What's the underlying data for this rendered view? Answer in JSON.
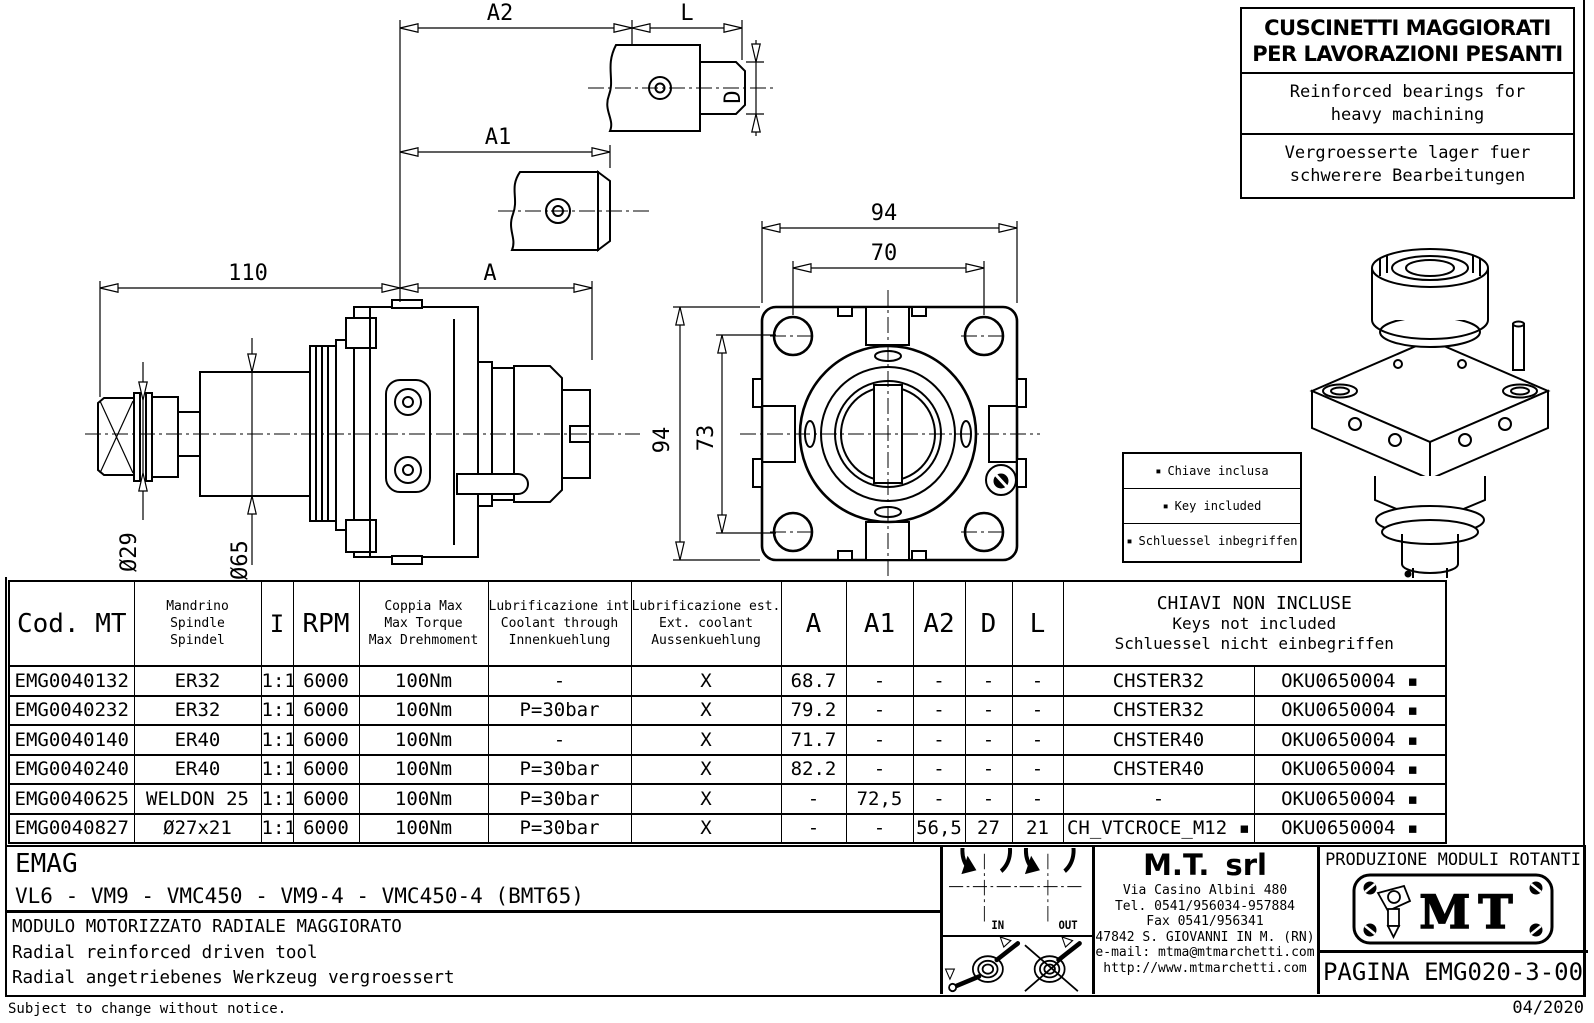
{
  "banner": {
    "it1": "CUSCINETTI MAGGIORATI",
    "it2": "PER LAVORAZIONI PESANTI",
    "en1": "Reinforced bearings for",
    "en2": "heavy machining",
    "de1": "Vergroesserte lager fuer",
    "de2": "schwerere Bearbeitungen"
  },
  "key_box": {
    "bullet": "▪",
    "it": "Chiave inclusa",
    "en": "Key included",
    "de": "Schluessel inbegriffen"
  },
  "dims": {
    "a2": "A2",
    "l": "L",
    "d": "D",
    "a1": "A1",
    "a": "A",
    "len110": "110",
    "dia29": "Ø29",
    "dia65": "Ø65",
    "w94": "94",
    "w70": "70",
    "h94": "94",
    "h73": "73"
  },
  "rotation": {
    "in_label": "IN",
    "out_label": "OUT"
  },
  "table": {
    "headers": {
      "cod": "Cod. MT",
      "mandrino": [
        "Mandrino",
        "Spindle",
        "Spindel"
      ],
      "ratio": "I",
      "rpm": "RPM",
      "torque": [
        "Coppia Max",
        "Max Torque",
        "Max Drehmoment"
      ],
      "lub_int": [
        "Lubrificazione int.",
        "Coolant through",
        "Innenkuehlung"
      ],
      "lub_est": [
        "Lubrificazione est.",
        "Ext. coolant",
        "Aussenkuehlung"
      ],
      "a": "A",
      "a1": "A1",
      "a2": "A2",
      "d": "D",
      "l": "L",
      "keys": [
        "CHIAVI NON INCLUSE",
        "Keys not included",
        "Schluessel nicht einbegriffen"
      ]
    },
    "rows": [
      [
        "EMG0040132",
        "ER32",
        "1:1",
        "6000",
        "100Nm",
        "-",
        "X",
        "68.7",
        "-",
        "-",
        "-",
        "-",
        "CHSTER32",
        "OKU0650004 ▪"
      ],
      [
        "EMG0040232",
        "ER32",
        "1:1",
        "6000",
        "100Nm",
        "P=30bar",
        "X",
        "79.2",
        "-",
        "-",
        "-",
        "-",
        "CHSTER32",
        "OKU0650004 ▪"
      ],
      [
        "EMG0040140",
        "ER40",
        "1:1",
        "6000",
        "100Nm",
        "-",
        "X",
        "71.7",
        "-",
        "-",
        "-",
        "-",
        "CHSTER40",
        "OKU0650004 ▪"
      ],
      [
        "EMG0040240",
        "ER40",
        "1:1",
        "6000",
        "100Nm",
        "P=30bar",
        "X",
        "82.2",
        "-",
        "-",
        "-",
        "-",
        "CHSTER40",
        "OKU0650004 ▪"
      ],
      [
        "EMG0040625",
        "WELDON 25",
        "1:1",
        "6000",
        "100Nm",
        "P=30bar",
        "X",
        "-",
        "72,5",
        "-",
        "-",
        "-",
        "-",
        "OKU0650004 ▪"
      ],
      [
        "EMG0040827",
        "Ø27x21",
        "1:1",
        "6000",
        "100Nm",
        "P=30bar",
        "X",
        "-",
        "-",
        "56,5",
        "27",
        "21",
        "CH_VTCROCE_M12 ▪",
        "OKU0650004 ▪"
      ]
    ]
  },
  "title_block": {
    "customer": "EMAG",
    "machines": "VL6 - VM9 - VMC450 - VM9-4 - VMC450-4  (BMT65)",
    "title_it": "MODULO MOTORIZZATO RADIALE MAGGIORATO",
    "title_en": "Radial reinforced driven tool",
    "title_de": "Radial angetriebenes Werkzeug vergroessert",
    "company": "M.T. srl",
    "address": "Via Casino Albini 480",
    "phone": "Tel. 0541/956034-957884",
    "fax": "Fax 0541/956341",
    "city": "47842 S. GIOVANNI IN M. (RN)",
    "email": "e-mail: mtma@mtmarchetti.com",
    "web": "http://www.mtmarchetti.com",
    "production": "PRODUZIONE MODULI ROTANTI",
    "logo_text": "MT",
    "page_label": "PAGINA EMG020-3-00"
  },
  "footer": {
    "note": "Subject to change without notice.",
    "date": "04/2020"
  }
}
